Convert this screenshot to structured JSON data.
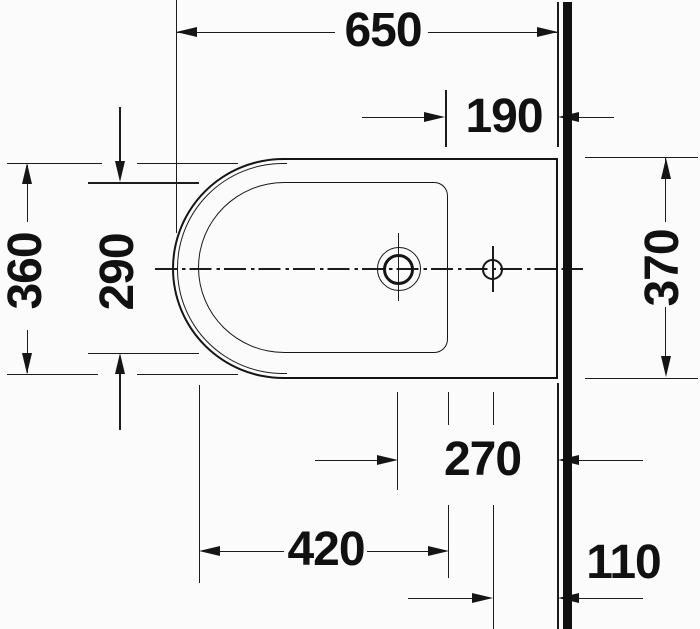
{
  "drawing": {
    "dimensions": {
      "overall_length": "650",
      "tap_zone_to_wall": "190",
      "overall_width": "360",
      "bowl_width": "290",
      "wall_side_width": "370",
      "tap_center_to_wall": "270",
      "bowl_length": "420",
      "hole_center_to_wall": "110"
    },
    "colors": {
      "line": "#1c1c1c",
      "wall": "#101010",
      "background": "#fbfbfb"
    }
  }
}
